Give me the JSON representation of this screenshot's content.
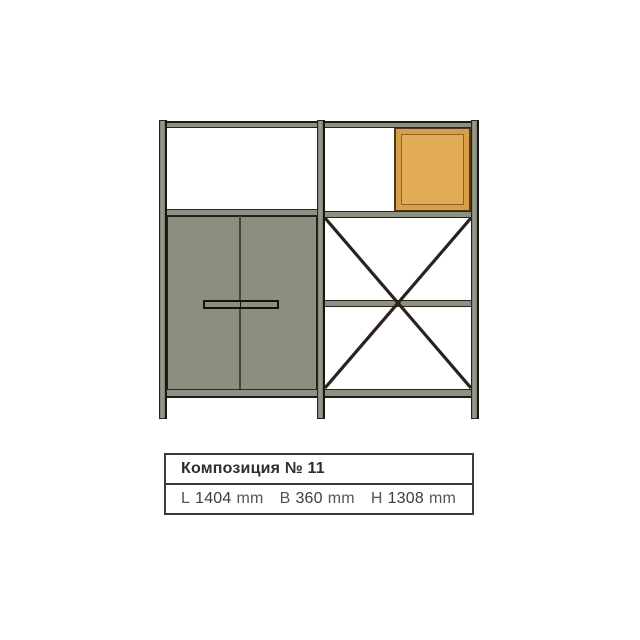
{
  "spec": {
    "title": "Композиция № 11",
    "dimensions": [
      {
        "label": "L",
        "value": "1404",
        "unit": "mm"
      },
      {
        "label": "B",
        "value": "360",
        "unit": "mm"
      },
      {
        "label": "H",
        "value": "1308",
        "unit": "mm"
      }
    ]
  },
  "drawing": {
    "type": "furniture-shelving-composition",
    "colors": {
      "frame": "#8e9182",
      "frame_light": "#9b9e8f",
      "frame_dark": "#7c7f70",
      "cabinet": "#8c8f7d",
      "accent": "#d89f48",
      "accent_light": "#e2ab55",
      "outline": "#26261f",
      "brace": "#2b221c"
    }
  }
}
